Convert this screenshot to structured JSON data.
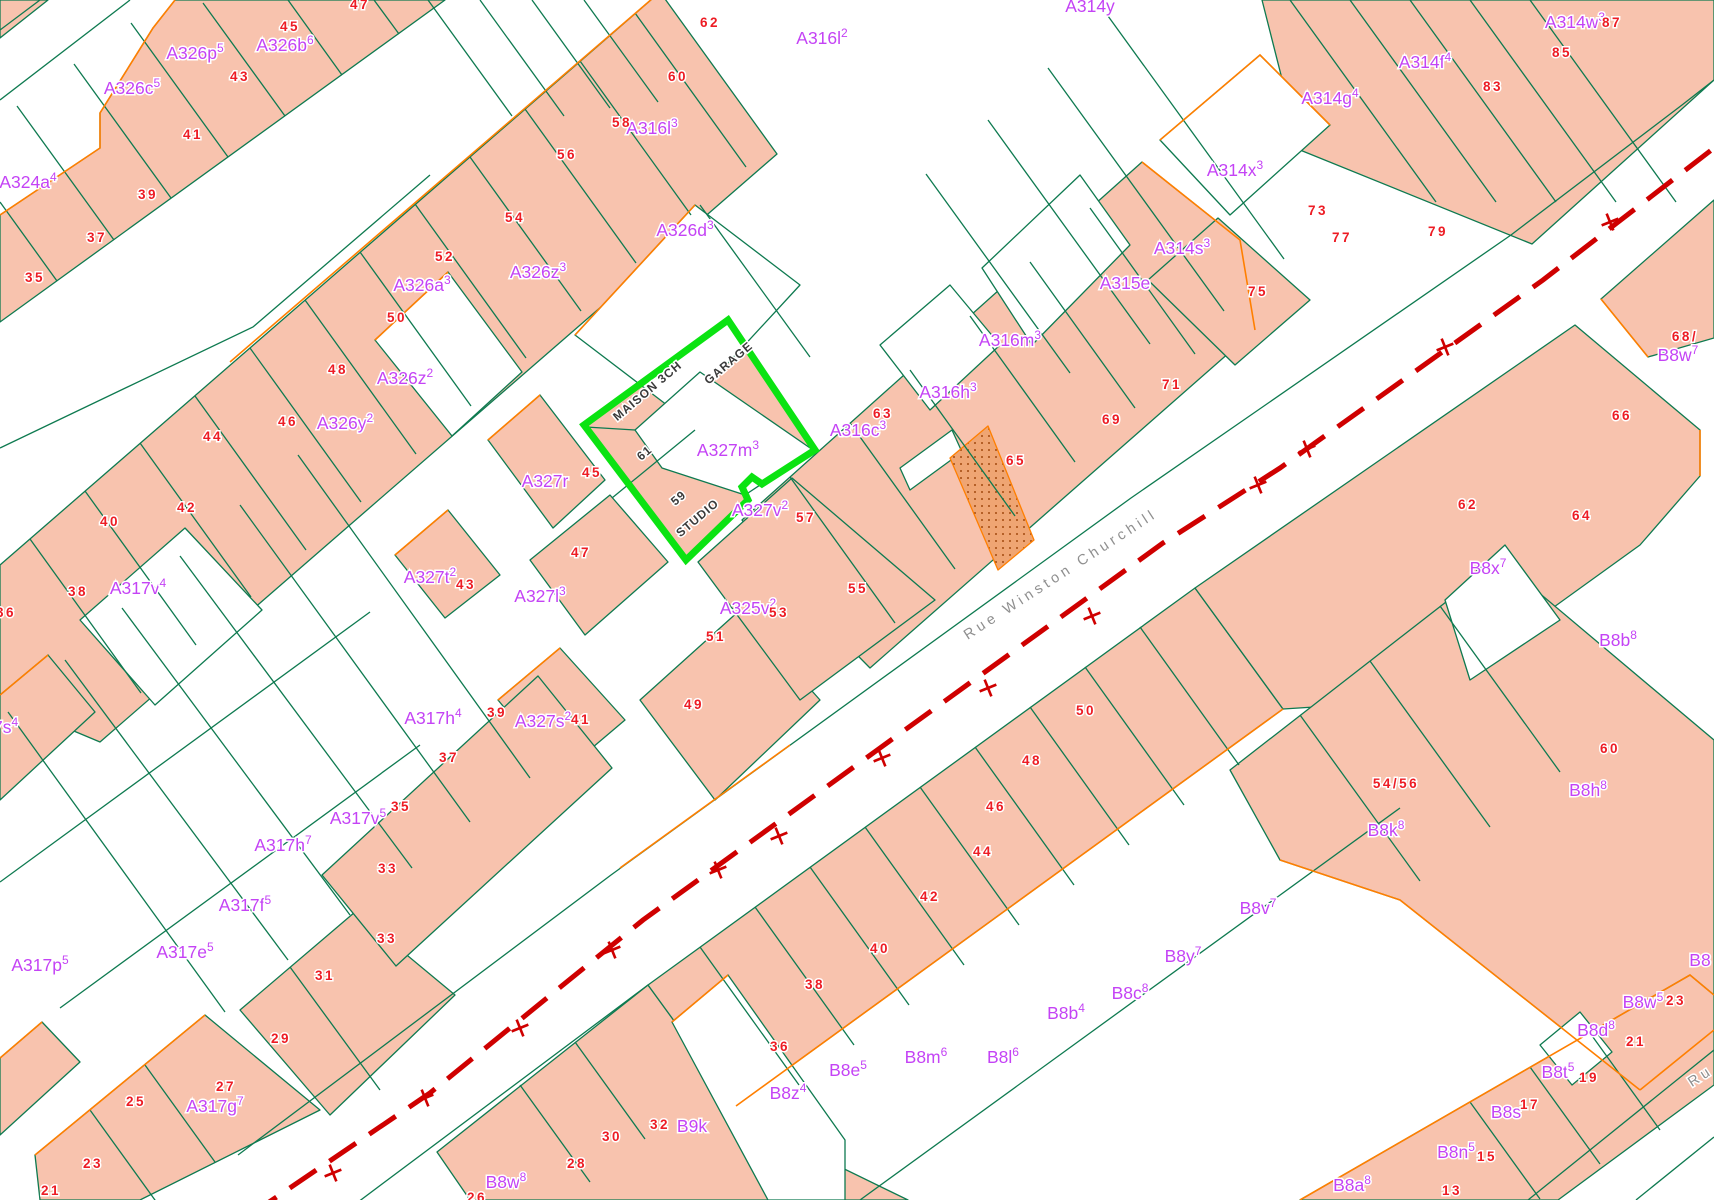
{
  "map": {
    "title": "Cadastral parcel map",
    "width": 1714,
    "height": 1200,
    "colors": {
      "parcel_fill": "#f8c3ae",
      "hatch_fill": "#efa573",
      "hatch_dot": "#a34a10",
      "boundary_green": "#0e7a50",
      "boundary_orange": "#ff7f00",
      "label_magenta": "#c443f5",
      "number_red": "#ed1c24",
      "centerline_red": "#cf0000",
      "highlight_green": "#0be312",
      "building_text": "#3a3a3a",
      "street_text": "#8f8f8f",
      "white": "#ffffff"
    },
    "street": {
      "name": "Rue Winston Churchill",
      "x": 1063,
      "y": 578,
      "rot": -33,
      "partial_name": "Ru",
      "px": 1703,
      "py": 1080,
      "prot": -33,
      "centerline": "250,1215 430,1093 643,920 880,748 1163,543 1280,468 1543,280 1714,148",
      "ticks": [
        [
          333,
          1173
        ],
        [
          425,
          1098
        ],
        [
          520,
          1028
        ],
        [
          612,
          950
        ],
        [
          718,
          870
        ],
        [
          779,
          836
        ],
        [
          882,
          758
        ],
        [
          988,
          688
        ],
        [
          1092,
          616
        ],
        [
          1258,
          485
        ],
        [
          1307,
          449
        ],
        [
          1445,
          347
        ],
        [
          1610,
          222
        ]
      ]
    },
    "highlight": {
      "name": "selected parcel 59-61",
      "points": "728,320 815,450 762,484 752,477 742,487 748,500 686,560 584,425",
      "courtyard": "635,430 700,372 813,450 745,495 662,468"
    },
    "parcels": [
      {
        "f": "s",
        "p": "0,215 100,148 100,113 153,28 175,0 445,0 0,322"
      },
      {
        "f": "s",
        "p": "0,0 48,0 0,38"
      },
      {
        "f": "s",
        "p": "0,565 660,-8 777,154 100,742 0,700"
      },
      {
        "f": "s",
        "p": "742,520 1142,162 1240,240 1255,330 870,668 795,592"
      },
      {
        "f": "s",
        "p": "1262,0 1714,0 1714,80 1532,244 1300,150"
      },
      {
        "f": "s",
        "p": "1148,280 1218,218 1310,300 1235,365"
      },
      {
        "f": "s",
        "p": "1601,299 1714,200 1714,338 1648,357"
      },
      {
        "f": "s",
        "p": "437,1152 648,985 748,1122 908,1200 470,1200"
      },
      {
        "f": "s",
        "p": "648,985 1195,588 1283,709 736,1106"
      },
      {
        "f": "s",
        "p": "1195,588 1575,325 1700,430 1700,476 1640,545 1425,700 1283,709"
      },
      {
        "f": "s",
        "p": "1230,770 1500,560 1714,740 1714,1030 1640,1090 1400,900 1280,860"
      },
      {
        "f": "s",
        "p": "1300,1200 1690,975 1714,995 1714,1085 1558,1200"
      },
      {
        "f": "s",
        "p": "488,440 540,395 605,480 553,528"
      },
      {
        "f": "s",
        "p": "395,555 448,510 500,575 445,618"
      },
      {
        "f": "s",
        "p": "530,560 610,495 668,562 585,635"
      },
      {
        "f": "s",
        "p": "498,700 560,648 625,720 560,775"
      },
      {
        "f": "s",
        "p": "640,700 740,610 820,700 715,800"
      },
      {
        "f": "s",
        "p": "698,562 792,478 935,600 800,700"
      },
      {
        "f": "s",
        "p": "240,1010 355,912 455,995 330,1115"
      },
      {
        "f": "s",
        "p": "35,1155 205,1015 320,1110 140,1200 40,1200"
      },
      {
        "f": "s",
        "p": "0,1058 42,1022 80,1062 0,1135"
      },
      {
        "f": "s",
        "p": "0,695 48,655 95,712 0,800"
      },
      {
        "f": "s",
        "p": "322,875 538,676 612,768 396,966"
      },
      {
        "f": "s",
        "p": "728,320 815,450 762,484 752,477 742,487 748,500 686,560 584,425"
      },
      {
        "f": "w",
        "p": "375,340 448,272 522,372 452,436"
      },
      {
        "f": "w",
        "p": "80,620 185,528 262,610 155,705"
      },
      {
        "f": "w",
        "p": "575,335 695,205 800,285 680,415"
      },
      {
        "f": "w",
        "p": "880,345 950,285 1000,345 930,410"
      },
      {
        "f": "w",
        "p": "982,268 1080,175 1130,245 1032,345"
      },
      {
        "f": "w",
        "p": "1160,140 1260,55 1330,125 1230,215"
      },
      {
        "f": "w",
        "p": "672,1022 728,975 845,1140 845,1200 768,1200"
      },
      {
        "f": "w",
        "p": "1445,600 1505,545 1560,620 1470,680"
      },
      {
        "f": "w",
        "p": "1540,1045 1580,1012 1612,1052 1572,1085"
      },
      {
        "f": "w",
        "p": "900,468 952,430 962,452 910,490"
      },
      {
        "f": "w",
        "p": "635,430 700,372 813,450 745,495 662,468"
      },
      {
        "f": "h",
        "p": "950,458 988,426 1034,540 998,570"
      }
    ],
    "green_lines": [
      "57,281 0,202",
      "114,240 17,106",
      "171,198 74,64",
      "228,157 131,23",
      "285,116 203,3",
      "342,75 288,0",
      "399,34 374,0",
      "0,100 130,0",
      "0,30 40,0",
      "30,539 141,693",
      "85,491 196,645",
      "140,443 251,597",
      "195,396 306,550",
      "250,348 361,502",
      "305,300 416,454",
      "360,252 471,406",
      "415,204 526,358",
      "470,157 581,311",
      "525,109 636,263",
      "580,61 691,215",
      "635,13 746,167",
      "428,0 512,116",
      "480,0 564,116",
      "532,0 610,108",
      "584,0 658,102",
      "790,477 895,623",
      "850,423 955,569",
      "910,370 1015,516",
      "970,316 1075,462",
      "1030,262 1135,408",
      "1090,208 1195,354",
      "1290,0 1436,202",
      "1350,0 1496,202",
      "1410,0 1556,202",
      "1470,0 1616,202",
      "1530,0 1676,202",
      "700,947 799,1085",
      "755,907 854,1045",
      "810,867 909,1005",
      "865,827 964,965",
      "920,787 1019,925",
      "975,747 1074,885",
      "1030,707 1129,845",
      "1085,667 1184,805",
      "1140,627 1239,765",
      "1300,715 1420,881",
      "1370,661 1490,827",
      "1440,606 1560,772",
      "1470,1102 1540,1199",
      "1530,1067 1600,1164",
      "1590,1033 1660,1130",
      "90,1110 160,1207",
      "145,1065 215,1162",
      "290,967 380,1090",
      "520,1085 590,1182",
      "575,1042 645,1139",
      "8,712 225,1012",
      "65,660 288,960",
      "122,608 350,915",
      "180,556 412,868",
      "240,505 470,822",
      "298,455 530,778",
      "0,882 370,612",
      "60,1008 420,745",
      "1048,68 1224,311",
      "1108,16 1284,259",
      "988,120 1150,344",
      "926,174 1070,373",
      "238,1155 611,875 1131,498 1511,235 1682,105 1714,80",
      "302,1244 648,985",
      "1528,1200 1714,1050",
      "1636,1200 1714,1137",
      "860,1200 1400,808",
      "700,205 810,357",
      "0,448 253,327 430,175",
      "612,498 695,430",
      "586,427 635,430"
    ],
    "orange_lines": [
      "0,215 100,148 100,113 153,28 175,0",
      "230,362 660,-8",
      "375,340 448,272",
      "1142,162 1240,240 1255,330",
      "1160,140 1260,55 1330,125",
      "1300,1200 1690,975 1714,995",
      "1640,1090 1400,900 1280,860",
      "1714,1030 1640,1090",
      "736,1106 1283,709",
      "35,1155 205,1015",
      "0,1058 42,1022",
      "0,695 48,655",
      "488,440 540,395",
      "395,555 448,510",
      "498,700 560,648",
      "575,335 695,205",
      "1601,299 1648,357",
      "1700,430 1700,476",
      "620,868 790,745",
      "672,1022 728,975"
    ],
    "parcel_labels": [
      {
        "t": "A324a",
        "s": "4",
        "x": 28,
        "y": 182
      },
      {
        "t": "A326c",
        "s": "5",
        "x": 132,
        "y": 88
      },
      {
        "t": "A326p",
        "s": "5",
        "x": 195,
        "y": 53
      },
      {
        "t": "A326b",
        "s": "6",
        "x": 285,
        "y": 45
      },
      {
        "t": "A326a",
        "s": "3",
        "x": 422,
        "y": 285
      },
      {
        "t": "A326z",
        "s": "2",
        "x": 405,
        "y": 378
      },
      {
        "t": "A326y",
        "s": "2",
        "x": 345,
        "y": 423
      },
      {
        "t": "A326z",
        "s": "3",
        "x": 538,
        "y": 272
      },
      {
        "t": "A326d",
        "s": "3",
        "x": 685,
        "y": 230
      },
      {
        "t": "A316l",
        "s": "3",
        "x": 652,
        "y": 128
      },
      {
        "t": "A316l",
        "s": "2",
        "x": 822,
        "y": 38
      },
      {
        "t": "A314y",
        "s": "",
        "x": 1090,
        "y": 6
      },
      {
        "t": "A314w",
        "s": "3",
        "x": 1575,
        "y": 22
      },
      {
        "t": "A314g",
        "s": "4",
        "x": 1330,
        "y": 98
      },
      {
        "t": "A314f",
        "s": "4",
        "x": 1425,
        "y": 62
      },
      {
        "t": "A314x",
        "s": "3",
        "x": 1235,
        "y": 170
      },
      {
        "t": "A314s",
        "s": "3",
        "x": 1182,
        "y": 248
      },
      {
        "t": "A315e",
        "s": "",
        "x": 1125,
        "y": 283
      },
      {
        "t": "A316m",
        "s": "3",
        "x": 1010,
        "y": 340
      },
      {
        "t": "A316h",
        "s": "3",
        "x": 948,
        "y": 392
      },
      {
        "t": "A316c",
        "s": "3",
        "x": 858,
        "y": 430
      },
      {
        "t": "A327r",
        "s": "",
        "x": 545,
        "y": 481
      },
      {
        "t": "A327m",
        "s": "3",
        "x": 728,
        "y": 450
      },
      {
        "t": "A327t",
        "s": "2",
        "x": 430,
        "y": 577
      },
      {
        "t": "A327l",
        "s": "3",
        "x": 540,
        "y": 596
      },
      {
        "t": "A327s",
        "s": "2",
        "x": 543,
        "y": 721
      },
      {
        "t": "A325v",
        "s": "2",
        "x": 748,
        "y": 608
      },
      {
        "t": "A327v",
        "s": "2",
        "x": 760,
        "y": 510
      },
      {
        "t": "A317v",
        "s": "4",
        "x": 138,
        "y": 588
      },
      {
        "t": "A317h",
        "s": "4",
        "x": 433,
        "y": 718
      },
      {
        "t": "A317s",
        "s": "4",
        "x": -10,
        "y": 727
      },
      {
        "t": "A317h",
        "s": "7",
        "x": 283,
        "y": 845
      },
      {
        "t": "A317v",
        "s": "5",
        "x": 358,
        "y": 818
      },
      {
        "t": "A317f",
        "s": "5",
        "x": 245,
        "y": 905
      },
      {
        "t": "A317e",
        "s": "5",
        "x": 185,
        "y": 952
      },
      {
        "t": "A317p",
        "s": "5",
        "x": 40,
        "y": 965
      },
      {
        "t": "A317g",
        "s": "7",
        "x": 215,
        "y": 1106
      },
      {
        "t": "B8w",
        "s": "7",
        "x": 1678,
        "y": 355
      },
      {
        "t": "B8x",
        "s": "7",
        "x": 1488,
        "y": 568
      },
      {
        "t": "B8b",
        "s": "8",
        "x": 1618,
        "y": 640
      },
      {
        "t": "B8h",
        "s": "8",
        "x": 1588,
        "y": 790
      },
      {
        "t": "B8k",
        "s": "8",
        "x": 1386,
        "y": 830
      },
      {
        "t": "B8v",
        "s": "7",
        "x": 1258,
        "y": 908
      },
      {
        "t": "B8y",
        "s": "7",
        "x": 1183,
        "y": 956
      },
      {
        "t": "B8c",
        "s": "8",
        "x": 1130,
        "y": 993
      },
      {
        "t": "B8b",
        "s": "4",
        "x": 1066,
        "y": 1013
      },
      {
        "t": "B8m",
        "s": "6",
        "x": 926,
        "y": 1057
      },
      {
        "t": "B8l",
        "s": "6",
        "x": 1003,
        "y": 1057
      },
      {
        "t": "B8e",
        "s": "5",
        "x": 848,
        "y": 1070
      },
      {
        "t": "B8z",
        "s": "4",
        "x": 788,
        "y": 1093
      },
      {
        "t": "B9k",
        "s": "",
        "x": 692,
        "y": 1126
      },
      {
        "t": "B8w",
        "s": "8",
        "x": 506,
        "y": 1182
      },
      {
        "t": "B8w",
        "s": "5",
        "x": 1643,
        "y": 1002
      },
      {
        "t": "B8d",
        "s": "8",
        "x": 1596,
        "y": 1030
      },
      {
        "t": "B8t",
        "s": "5",
        "x": 1558,
        "y": 1072
      },
      {
        "t": "B8s",
        "s": "",
        "x": 1506,
        "y": 1112
      },
      {
        "t": "B8n",
        "s": "5",
        "x": 1456,
        "y": 1152
      },
      {
        "t": "B8a",
        "s": "8",
        "x": 1352,
        "y": 1185
      },
      {
        "t": "B8",
        "s": "",
        "x": 1700,
        "y": 960
      }
    ],
    "house_numbers": [
      {
        "t": "47",
        "x": 360,
        "y": 4
      },
      {
        "t": "45",
        "x": 290,
        "y": 26
      },
      {
        "t": "43",
        "x": 240,
        "y": 76
      },
      {
        "t": "41",
        "x": 193,
        "y": 134
      },
      {
        "t": "39",
        "x": 148,
        "y": 194
      },
      {
        "t": "37",
        "x": 97,
        "y": 237
      },
      {
        "t": "35",
        "x": 35,
        "y": 277
      },
      {
        "t": "62",
        "x": 710,
        "y": 22
      },
      {
        "t": "60",
        "x": 678,
        "y": 76
      },
      {
        "t": "58",
        "x": 622,
        "y": 122
      },
      {
        "t": "56",
        "x": 567,
        "y": 154
      },
      {
        "t": "54",
        "x": 515,
        "y": 217
      },
      {
        "t": "52",
        "x": 445,
        "y": 256
      },
      {
        "t": "50",
        "x": 397,
        "y": 317
      },
      {
        "t": "48",
        "x": 338,
        "y": 369
      },
      {
        "t": "46",
        "x": 288,
        "y": 421
      },
      {
        "t": "44",
        "x": 213,
        "y": 436
      },
      {
        "t": "42",
        "x": 187,
        "y": 507
      },
      {
        "t": "40",
        "x": 110,
        "y": 521
      },
      {
        "t": "38",
        "x": 78,
        "y": 591
      },
      {
        "t": "36",
        "x": 6,
        "y": 612
      },
      {
        "t": "87",
        "x": 1612,
        "y": 22
      },
      {
        "t": "85",
        "x": 1562,
        "y": 52
      },
      {
        "t": "83",
        "x": 1493,
        "y": 86
      },
      {
        "t": "79",
        "x": 1438,
        "y": 231
      },
      {
        "t": "77",
        "x": 1342,
        "y": 237
      },
      {
        "t": "75",
        "x": 1258,
        "y": 291
      },
      {
        "t": "73",
        "x": 1318,
        "y": 210
      },
      {
        "t": "71",
        "x": 1172,
        "y": 384
      },
      {
        "t": "69",
        "x": 1112,
        "y": 419
      },
      {
        "t": "65",
        "x": 1016,
        "y": 460
      },
      {
        "t": "63",
        "x": 883,
        "y": 413
      },
      {
        "t": "45",
        "x": 592,
        "y": 472
      },
      {
        "t": "43",
        "x": 466,
        "y": 584
      },
      {
        "t": "47",
        "x": 581,
        "y": 552
      },
      {
        "t": "41",
        "x": 581,
        "y": 719
      },
      {
        "t": "53",
        "x": 779,
        "y": 612
      },
      {
        "t": "57",
        "x": 806,
        "y": 517
      },
      {
        "t": "55",
        "x": 858,
        "y": 588
      },
      {
        "t": "51",
        "x": 716,
        "y": 636
      },
      {
        "t": "49",
        "x": 694,
        "y": 704
      },
      {
        "t": "39",
        "x": 497,
        "y": 712
      },
      {
        "t": "37",
        "x": 449,
        "y": 757
      },
      {
        "t": "35",
        "x": 401,
        "y": 806
      },
      {
        "t": "33",
        "x": 388,
        "y": 868
      },
      {
        "t": "33",
        "x": 387,
        "y": 938
      },
      {
        "t": "31",
        "x": 325,
        "y": 975
      },
      {
        "t": "29",
        "x": 281,
        "y": 1038
      },
      {
        "t": "27",
        "x": 226,
        "y": 1086
      },
      {
        "t": "25",
        "x": 136,
        "y": 1101
      },
      {
        "t": "23",
        "x": 93,
        "y": 1163
      },
      {
        "t": "21",
        "x": 51,
        "y": 1190
      },
      {
        "t": "40",
        "x": 880,
        "y": 948
      },
      {
        "t": "42",
        "x": 930,
        "y": 896
      },
      {
        "t": "44",
        "x": 983,
        "y": 851
      },
      {
        "t": "46",
        "x": 996,
        "y": 806
      },
      {
        "t": "48",
        "x": 1032,
        "y": 760
      },
      {
        "t": "50",
        "x": 1086,
        "y": 710
      },
      {
        "t": "38",
        "x": 815,
        "y": 984
      },
      {
        "t": "36",
        "x": 780,
        "y": 1046
      },
      {
        "t": "32",
        "x": 660,
        "y": 1124
      },
      {
        "t": "30",
        "x": 612,
        "y": 1136
      },
      {
        "t": "28",
        "x": 577,
        "y": 1163
      },
      {
        "t": "26",
        "x": 477,
        "y": 1197
      },
      {
        "t": "68/",
        "x": 1685,
        "y": 336
      },
      {
        "t": "66",
        "x": 1622,
        "y": 415
      },
      {
        "t": "62",
        "x": 1468,
        "y": 504
      },
      {
        "t": "64",
        "x": 1582,
        "y": 515
      },
      {
        "t": "54/56",
        "x": 1396,
        "y": 783
      },
      {
        "t": "60",
        "x": 1610,
        "y": 748
      },
      {
        "t": "23",
        "x": 1676,
        "y": 1000
      },
      {
        "t": "21",
        "x": 1636,
        "y": 1041
      },
      {
        "t": "19",
        "x": 1589,
        "y": 1077
      },
      {
        "t": "17",
        "x": 1530,
        "y": 1104
      },
      {
        "t": "15",
        "x": 1487,
        "y": 1156
      },
      {
        "t": "13",
        "x": 1452,
        "y": 1190
      }
    ],
    "building_texts": [
      {
        "t": "MAISON 3CH",
        "x": 650,
        "y": 390,
        "r": -40
      },
      {
        "t": "GARAGE",
        "x": 731,
        "y": 362,
        "r": -40
      },
      {
        "t": "61",
        "x": 647,
        "y": 452,
        "r": -40
      },
      {
        "t": "59",
        "x": 681,
        "y": 497,
        "r": -40
      },
      {
        "t": "STUDIO",
        "x": 700,
        "y": 517,
        "r": -40
      }
    ]
  }
}
